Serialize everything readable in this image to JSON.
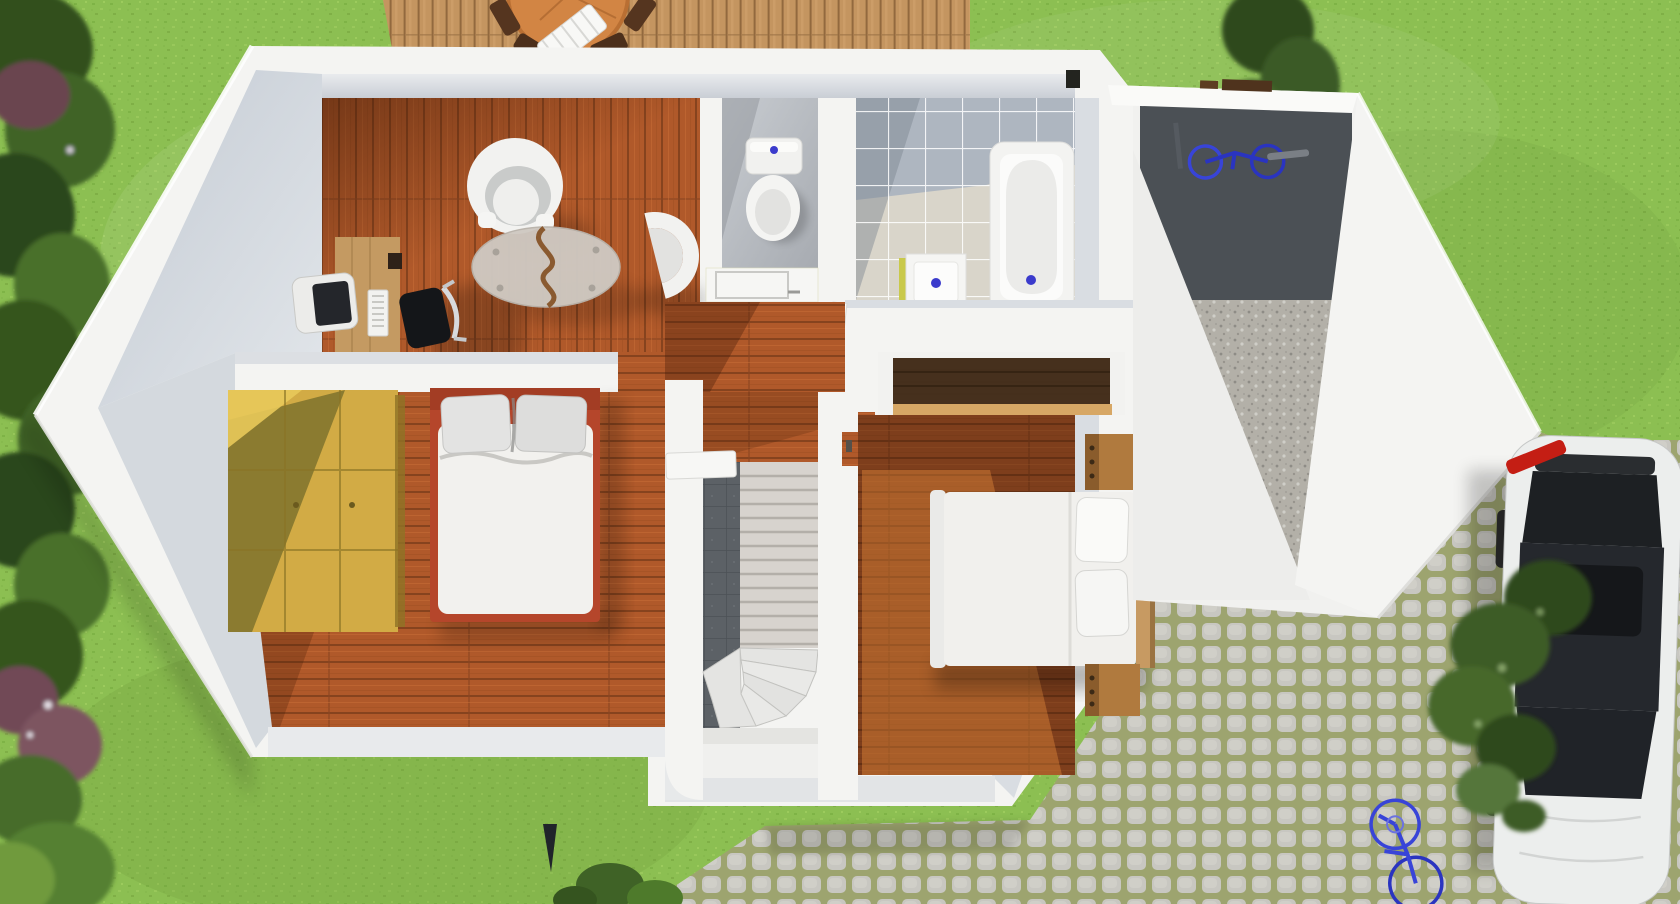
{
  "scene": {
    "title": "Top-down 3D rendering of a house floor plan with garden, wooden deck, garage annex, cobblestone driveway and parked car",
    "view": "top-down-3d-render",
    "visible_text": "none",
    "rooms": [
      {
        "name": "living-office",
        "floor": "wood-planks",
        "furniture": [
          "wooden-desk",
          "crt-monitor",
          "keyboard",
          "office-chair",
          "tub-armchair",
          "crescent-armchair",
          "oval-glass-coffee-table"
        ]
      },
      {
        "name": "bedroom-left",
        "floor": "wood-planks",
        "furniture": [
          "pine-wardrobe",
          "double-bed-red-frame",
          "two-pillows",
          "white-duvet"
        ]
      },
      {
        "name": "wc",
        "floor": "grey-screed",
        "furniture": [
          "toilet-with-cistern",
          "white-cabinet"
        ]
      },
      {
        "name": "bathroom",
        "floor": "grey-and-beige-tiles",
        "furniture": [
          "bathtub",
          "square-washbasin",
          "counter",
          "closet-with-clothes-rod"
        ]
      },
      {
        "name": "hallway",
        "floor": "wood-planks",
        "furniture": []
      },
      {
        "name": "staircase",
        "floor": "stone-and-white-treads",
        "furniture": [
          "straight-treads",
          "winder-treads",
          "landing",
          "dark-tile-strip"
        ]
      },
      {
        "name": "bedroom-right",
        "floor": "wood-planks",
        "furniture": [
          "double-bed-white",
          "wood-headboard",
          "two-pillows",
          "nightstand-top",
          "nightstand-bottom"
        ]
      },
      {
        "name": "garage-annex",
        "floor": "concrete-and-gravel",
        "furniture": [
          "blue-bicycle"
        ]
      }
    ],
    "exterior": [
      "lawn",
      "tree-row-left",
      "tree-top-right",
      "wood-deck",
      "patio-table",
      "patio-chairs",
      "sun-lounger",
      "cobblestone-path",
      "cobblestone-driveway",
      "white-car",
      "bushes",
      "blue-bicycle",
      "brown-fence-strip",
      "garden-stake"
    ]
  },
  "palette": {
    "grass": "#8cbf52",
    "grass_dark": "#6f9c3d",
    "wood_floor": "#b0592a",
    "wood_floor_dark": "#7c3d1b",
    "deck_wood": "#c49560",
    "wall_white": "#f4f4f2",
    "wall_face_grey": "#cfd5dc",
    "tile_grey": "#aeb6c0",
    "tile_beige": "#d9d5ca",
    "stair_dark_tile": "#5c6166",
    "cobble_stone": "#c6c5be",
    "cobble_moss": "#98a068",
    "bed_frame_red": "#b5462b",
    "wardrobe_wood": "#d2ab45",
    "closet_wood_dark": "#46301d",
    "rod_tan": "#d7a765",
    "fixture_accent_blue": "#3b3bcc",
    "car_body": "#eceeed",
    "car_glass": "#23262b",
    "car_taillight_red": "#c41e14",
    "bike_blue": "#3844d8",
    "gravel": "#b3b0a8"
  },
  "labels": {
    "scene": "3D top-down floor plan rendering",
    "lawn": "garden lawn",
    "trees_left": "tree and shrub row along left edge",
    "tree_top_right": "tree at top right",
    "deck": "wooden terrace with patio table, chairs and sun lounger",
    "house": "main house with white walls",
    "office": "home office and sitting area",
    "bedroom_left": "bedroom with red-framed double bed and pine wardrobe",
    "wc": "toilet room",
    "bathroom": "bathroom with bathtub and washbasin",
    "closet": "closet with clothes rod",
    "hallway": "hallway",
    "stairs": "winder staircase",
    "bedroom_right": "bedroom with white double bed and nightstands",
    "garage": "garage annex with bicycle",
    "cobbles": "cobblestone path and driveway",
    "car": "white car parked on driveway",
    "bushes": "bushes beside driveway",
    "bike_out": "blue bicycle on driveway",
    "fence": "brown fence strip",
    "stake": "garden stake"
  }
}
